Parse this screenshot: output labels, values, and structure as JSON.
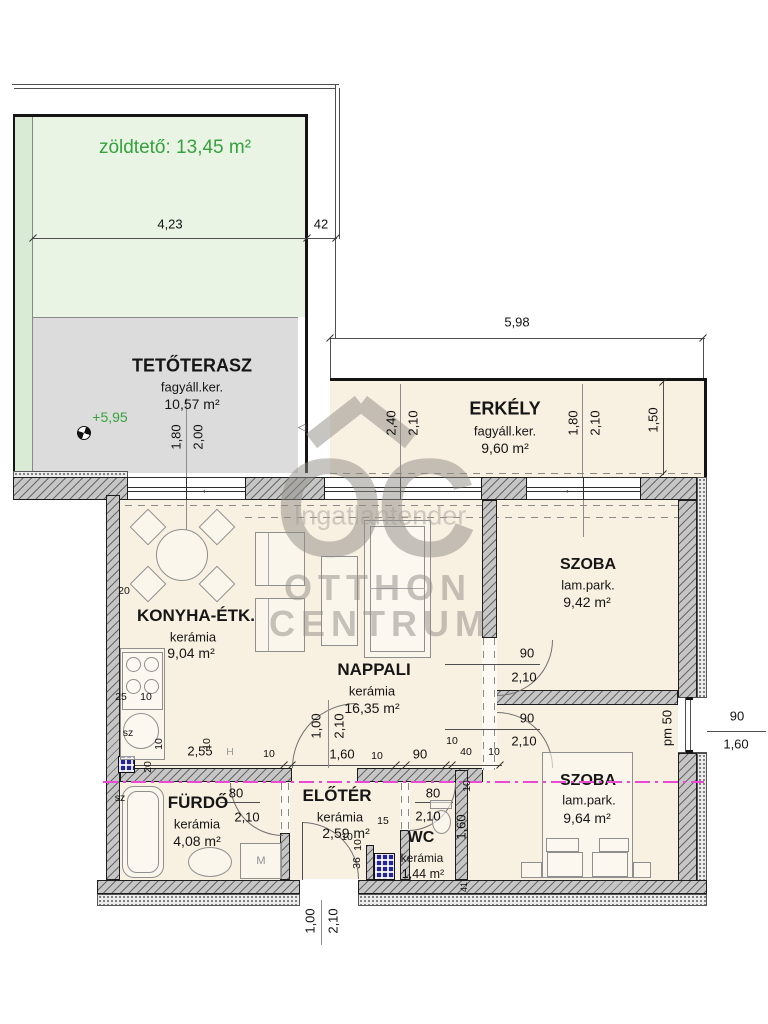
{
  "plan": {
    "type": "apartment floor plan"
  },
  "watermark": {
    "letters": "OC",
    "backdrop": "Ingatlantender",
    "line1": "OTTHON",
    "line2": "CENTRUM"
  },
  "rooms": {
    "zoldteto": {
      "label": "zöldtető: 13,45 m²"
    },
    "tetoterasz": {
      "name": "TETŐTERASZ",
      "finish": "fagyáll.ker.",
      "area": "10,57 m²",
      "level": "+5,95"
    },
    "erkely": {
      "name": "ERKÉLY",
      "finish": "fagyáll.ker.",
      "area": "9,60 m²"
    },
    "konyha": {
      "name": "KONYHA-ÉTK.",
      "finish": "kerámia",
      "area": "9,04 m²"
    },
    "nappali": {
      "name": "NAPPALI",
      "finish": "kerámia",
      "area": "16,35 m²"
    },
    "szoba_felso": {
      "name": "SZOBA",
      "finish": "lam.park.",
      "area": "9,42 m²"
    },
    "szoba_also": {
      "name": "SZOBA",
      "finish": "lam.park.",
      "area": "9,64 m²"
    },
    "furdo": {
      "name": "FÜRDŐ",
      "finish": "kerámia",
      "area": "4,08 m²"
    },
    "eloter": {
      "name": "ELŐTÉR",
      "finish": "kerámia",
      "area": "2,59 m²"
    },
    "wc": {
      "name": "WC",
      "finish": "kerámia",
      "area": "1,44 m²"
    }
  },
  "fixtures": {
    "washing_machine_label": "M"
  },
  "icons": {
    "slide_arrow_left": "←",
    "slide_arrow_right": "→",
    "terrace_arrow": "◁"
  },
  "colors": {
    "green_text": "#35a23d",
    "green_fill": "#e9f4e5",
    "green_strip": "#d9ebd4",
    "terrace_fill": "#dcdcdc",
    "room_fill": "#f8f0e1",
    "section_line": "#eb49d5"
  },
  "dim_labels": [
    {
      "text": "4,23",
      "x": 170,
      "y": 224
    },
    {
      "text": "42",
      "x": 321,
      "y": 224
    },
    {
      "text": "5,98",
      "x": 517,
      "y": 322
    },
    {
      "text": "1,80",
      "x": 176,
      "y": 437,
      "rot": -90
    },
    {
      "text": "2,00",
      "x": 198,
      "y": 437,
      "rot": -90
    },
    {
      "text": "2,40",
      "x": 391,
      "y": 423,
      "rot": -90
    },
    {
      "text": "2,10",
      "x": 413,
      "y": 423,
      "rot": -90
    },
    {
      "text": "1,80",
      "x": 573,
      "y": 423,
      "rot": -90
    },
    {
      "text": "2,10",
      "x": 595,
      "y": 423,
      "rot": -90
    },
    {
      "text": "1,50",
      "x": 653,
      "y": 420,
      "rot": -90
    },
    {
      "text": "90",
      "x": 527,
      "y": 653
    },
    {
      "text": "2,10",
      "x": 524,
      "y": 677
    },
    {
      "text": "90",
      "x": 527,
      "y": 718
    },
    {
      "text": "2,10",
      "x": 524,
      "y": 741
    },
    {
      "text": "pm 50",
      "x": 667,
      "y": 728,
      "rot": -90
    },
    {
      "text": "90",
      "x": 737,
      "y": 716
    },
    {
      "text": "1,60",
      "x": 736,
      "y": 744
    },
    {
      "text": "20",
      "x": 124,
      "y": 591,
      "cls": "sm"
    },
    {
      "text": "25",
      "x": 121,
      "y": 697,
      "cls": "sm"
    },
    {
      "text": "10",
      "x": 146,
      "y": 697,
      "cls": "sm"
    },
    {
      "text": "sz",
      "x": 128,
      "y": 733,
      "cls": "sm"
    },
    {
      "text": "10",
      "x": 159,
      "y": 744,
      "rot": -90,
      "cls": "sm"
    },
    {
      "text": "10",
      "x": 207,
      "y": 744,
      "rot": -90,
      "cls": "sm"
    },
    {
      "text": "20",
      "x": 148,
      "y": 767,
      "rot": -90,
      "cls": "sm"
    },
    {
      "text": "sz",
      "x": 120,
      "y": 798,
      "cls": "sm"
    },
    {
      "text": "2,55",
      "x": 200,
      "y": 751
    },
    {
      "text": "H",
      "x": 230,
      "y": 752,
      "cls": "sm gry"
    },
    {
      "text": "10",
      "x": 269,
      "y": 754,
      "cls": "sm"
    },
    {
      "text": "1,00",
      "x": 316,
      "y": 726,
      "rot": -90
    },
    {
      "text": "2,10",
      "x": 339,
      "y": 726,
      "rot": -90
    },
    {
      "text": "1,60",
      "x": 342,
      "y": 754
    },
    {
      "text": "10",
      "x": 377,
      "y": 756,
      "cls": "sm"
    },
    {
      "text": "90",
      "x": 420,
      "y": 754
    },
    {
      "text": "10",
      "x": 452,
      "y": 741,
      "cls": "sm"
    },
    {
      "text": "40",
      "x": 466,
      "y": 752,
      "cls": "sm"
    },
    {
      "text": "10",
      "x": 494,
      "y": 752,
      "cls": "sm"
    },
    {
      "text": "80",
      "x": 236,
      "y": 793
    },
    {
      "text": "2,10",
      "x": 247,
      "y": 817
    },
    {
      "text": "80",
      "x": 433,
      "y": 793
    },
    {
      "text": "2,10",
      "x": 428,
      "y": 816
    },
    {
      "text": "15",
      "x": 383,
      "y": 821,
      "cls": "sm"
    },
    {
      "text": "10",
      "x": 347,
      "y": 837,
      "cls": "sm"
    },
    {
      "text": "10",
      "x": 358,
      "y": 845,
      "rot": -90,
      "cls": "sm"
    },
    {
      "text": "36",
      "x": 357,
      "y": 863,
      "rot": -90,
      "cls": "sm"
    },
    {
      "text": "10",
      "x": 467,
      "y": 786,
      "rot": -90,
      "cls": "sm"
    },
    {
      "text": "1,60",
      "x": 461,
      "y": 827,
      "rot": -90
    },
    {
      "text": "1,00",
      "x": 310,
      "y": 921,
      "rot": -90
    },
    {
      "text": "2,10",
      "x": 333,
      "y": 921,
      "rot": -90
    },
    {
      "text": "41",
      "x": 464,
      "y": 887,
      "rot": -90,
      "cls": "xs"
    }
  ]
}
